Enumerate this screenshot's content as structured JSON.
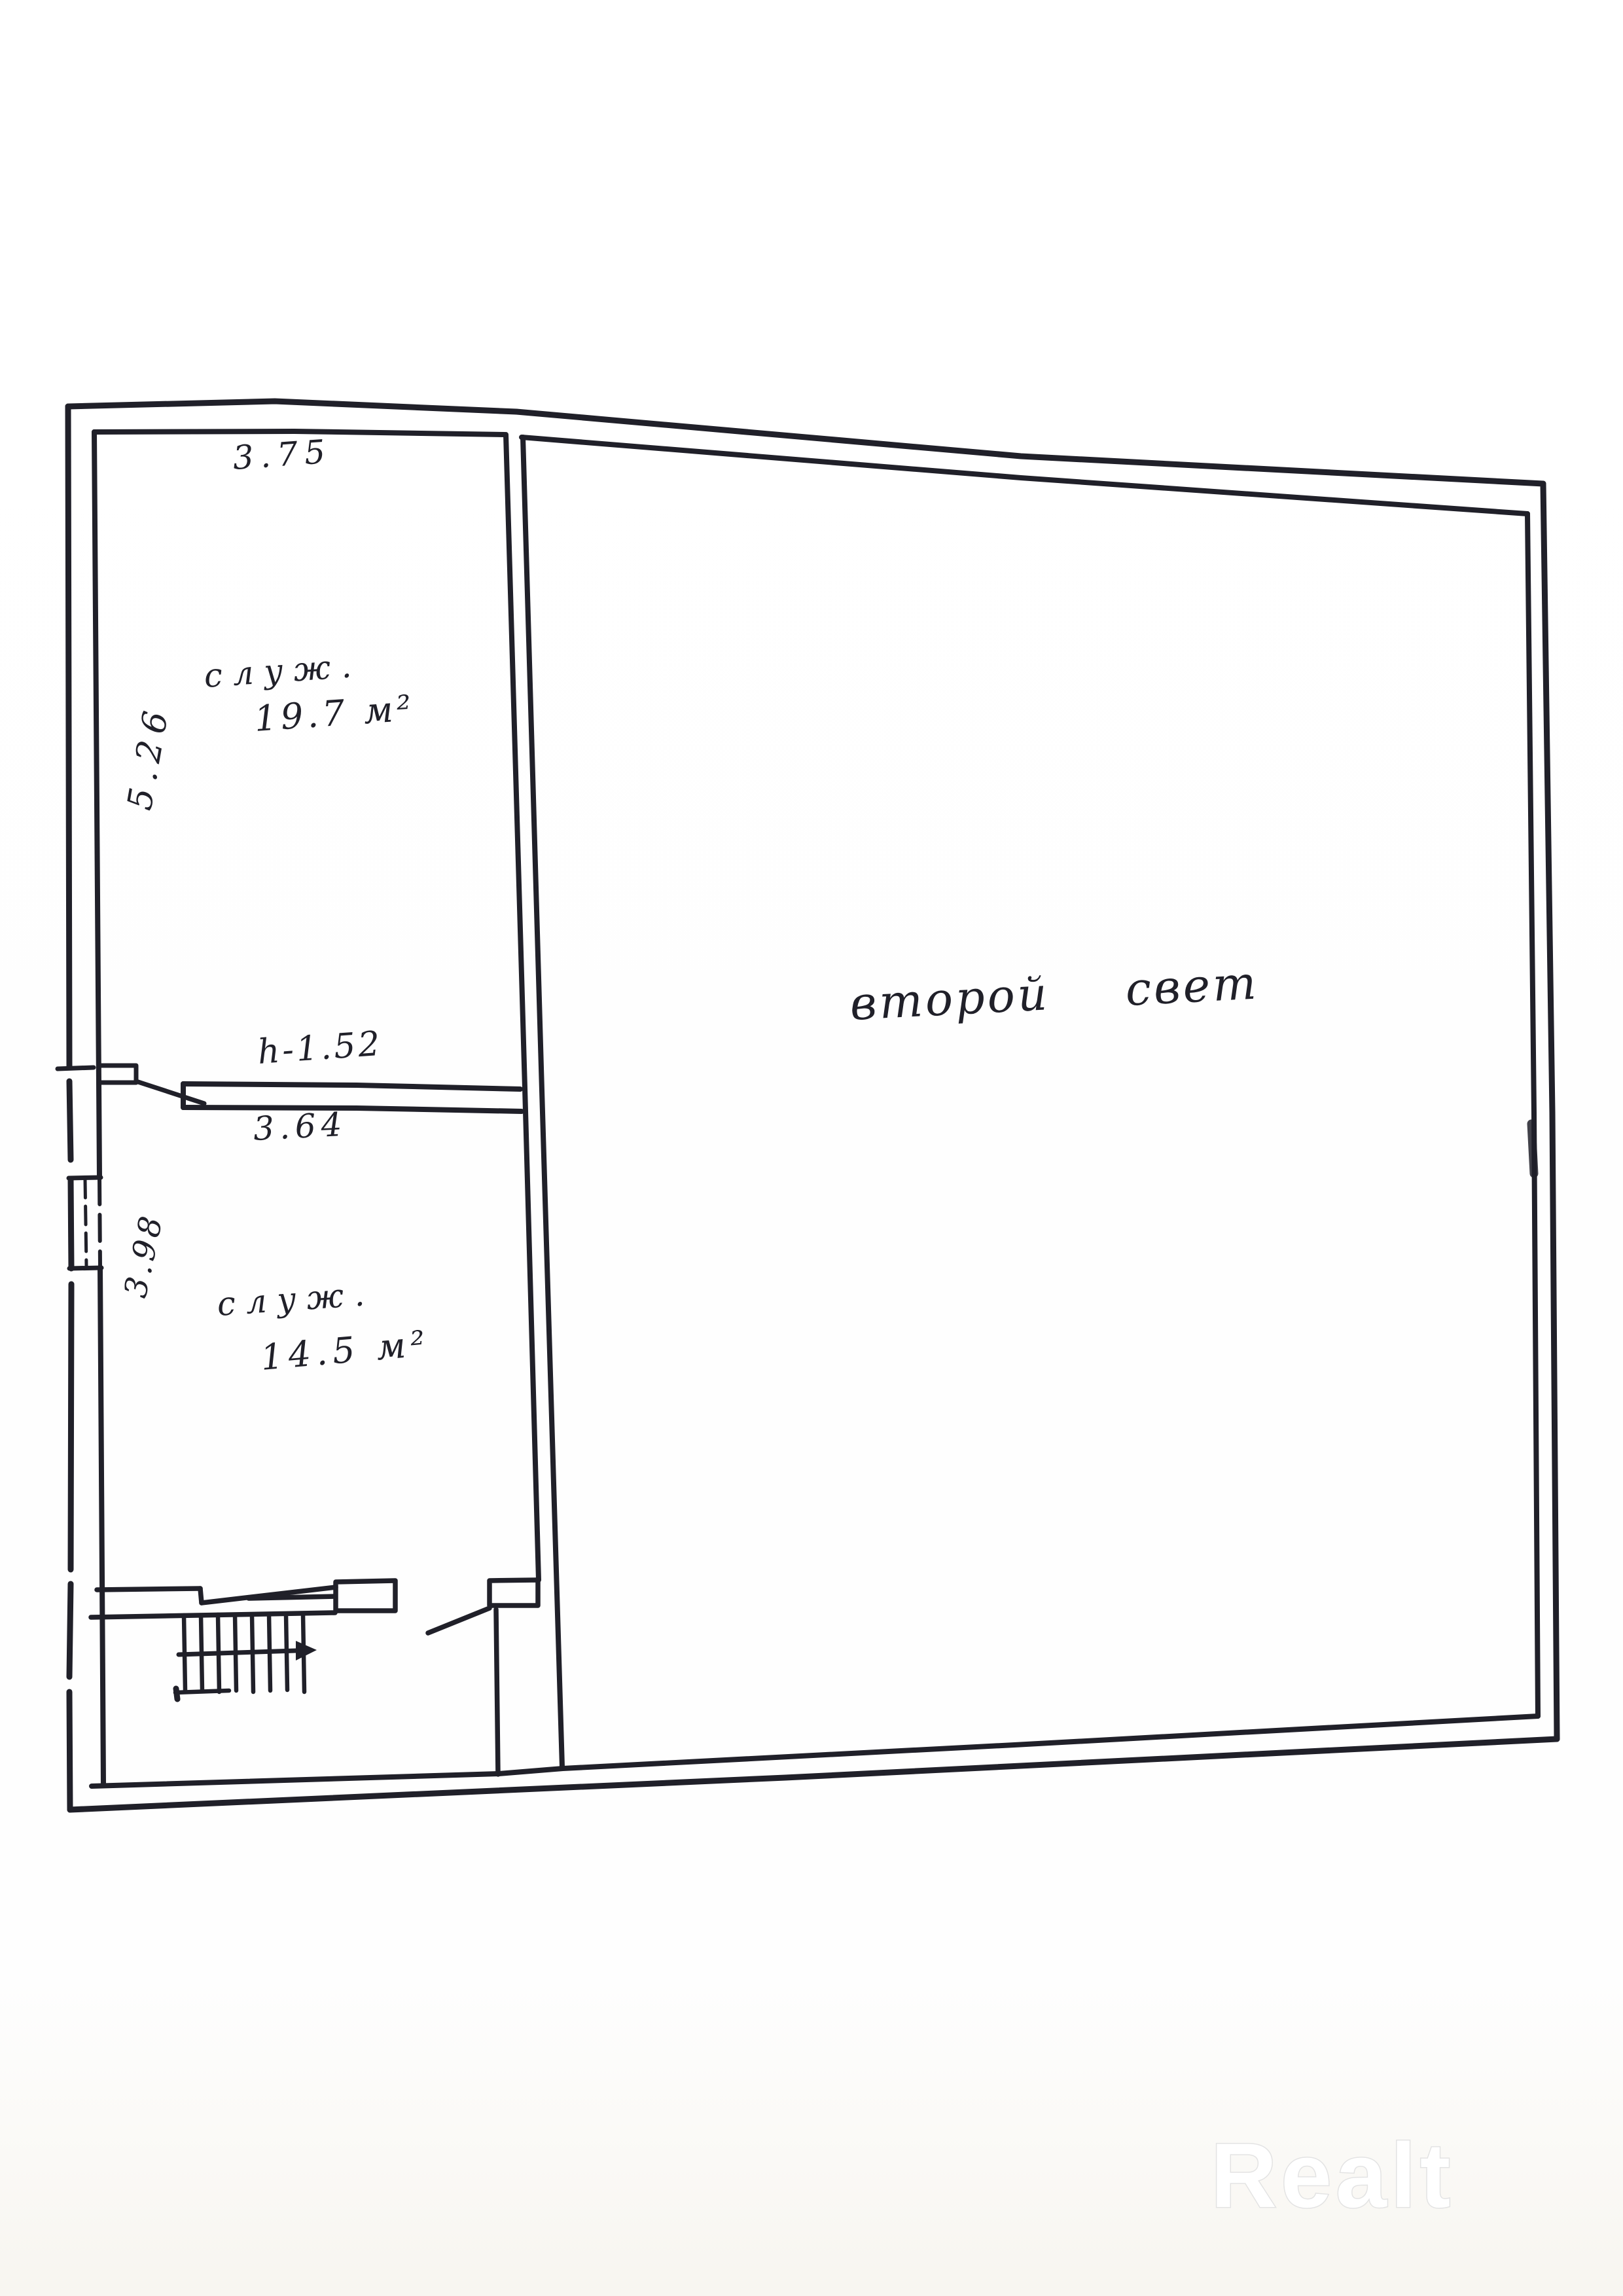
{
  "document": {
    "type": "hand-drawn floor plan scan"
  },
  "labels": {
    "room_upper_name": "служ.",
    "room_upper_area": "19.7 м²",
    "room_lower_name": "служ.",
    "room_lower_area": "14.5 м²",
    "hall_name": "второй свет",
    "height_note": "h-1.52"
  },
  "dimensions": {
    "top_width": "3.75",
    "upper_room_depth": "5.26",
    "partition_width": "3.64",
    "lower_room_depth": "3.98"
  },
  "watermark": {
    "text": "Realt"
  },
  "colors": {
    "ink": "#202029",
    "paper": "#fefefe",
    "watermark_stroke": "#e3e3e3"
  }
}
